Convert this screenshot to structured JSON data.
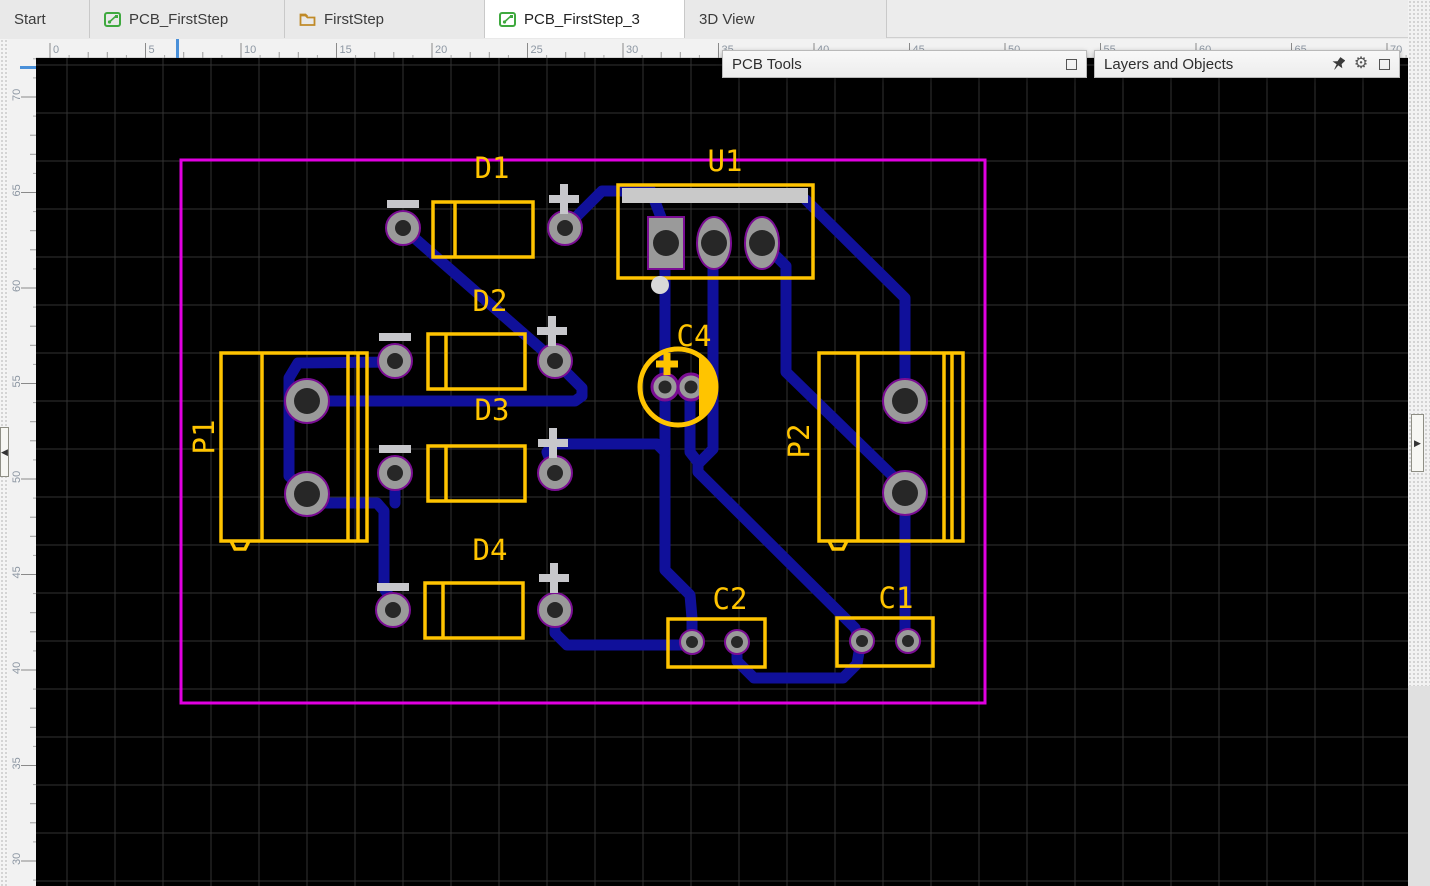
{
  "window": {
    "app": "PCB editor"
  },
  "tabs": [
    {
      "label": "Start",
      "icon": "none",
      "active": false
    },
    {
      "label": "PCB_FirstStep",
      "icon": "pcb",
      "active": false
    },
    {
      "label": "FirstStep",
      "icon": "folder",
      "active": false
    },
    {
      "label": "PCB_FirstStep_3",
      "icon": "pcb",
      "active": true
    },
    {
      "label": "3D View",
      "icon": "none",
      "active": false
    }
  ],
  "panels": {
    "pcb_tools": {
      "title": "PCB Tools",
      "icons": [
        "collapse-box"
      ]
    },
    "layers_objects": {
      "title": "Layers and Objects",
      "icons": [
        "pin",
        "gear",
        "collapse-box"
      ]
    }
  },
  "rulers": {
    "top_labels": [
      "0",
      "5",
      "10",
      "15",
      "20",
      "25",
      "30",
      "35",
      "40",
      "45",
      "50",
      "55",
      "60",
      "65",
      "70"
    ],
    "left_labels": [
      "70",
      "65",
      "60",
      "55",
      "50",
      "45",
      "40",
      "35",
      "30"
    ],
    "top_marker_x": 177,
    "left_marker_y": 67
  },
  "pcb": {
    "colors": {
      "background": "#000000",
      "grid": "#323232",
      "board_outline": "#E100E1",
      "trace": "#10109A",
      "silkscreen": "#FFC400",
      "pad_ring": "#9A9A9A",
      "pad_hole": "#272727",
      "pad_outline": "#7A0D93",
      "polarity_mark": "#C7C7CB",
      "u1_bar": "#C9C9C9",
      "u1_dot": "#D8D8D8"
    },
    "silkscreen_labels": [
      {
        "text": "D1",
        "x": 492,
        "y": 168,
        "rot": 0
      },
      {
        "text": "D2",
        "x": 490,
        "y": 301,
        "rot": 0
      },
      {
        "text": "D3",
        "x": 492,
        "y": 410,
        "rot": 0
      },
      {
        "text": "D4",
        "x": 490,
        "y": 550,
        "rot": 0
      },
      {
        "text": "U1",
        "x": 725,
        "y": 161,
        "rot": 0
      },
      {
        "text": "C4",
        "x": 694,
        "y": 336,
        "rot": 0
      },
      {
        "text": "C2",
        "x": 730,
        "y": 599,
        "rot": 0
      },
      {
        "text": "C1",
        "x": 896,
        "y": 598,
        "rot": 0
      },
      {
        "text": "P1",
        "x": 204,
        "y": 437,
        "rot": -90
      },
      {
        "text": "P2",
        "x": 799,
        "y": 441,
        "rot": -90
      }
    ],
    "components": [
      "D1",
      "D2",
      "D3",
      "D4",
      "U1",
      "C1",
      "C2",
      "C4",
      "P1",
      "P2"
    ]
  }
}
